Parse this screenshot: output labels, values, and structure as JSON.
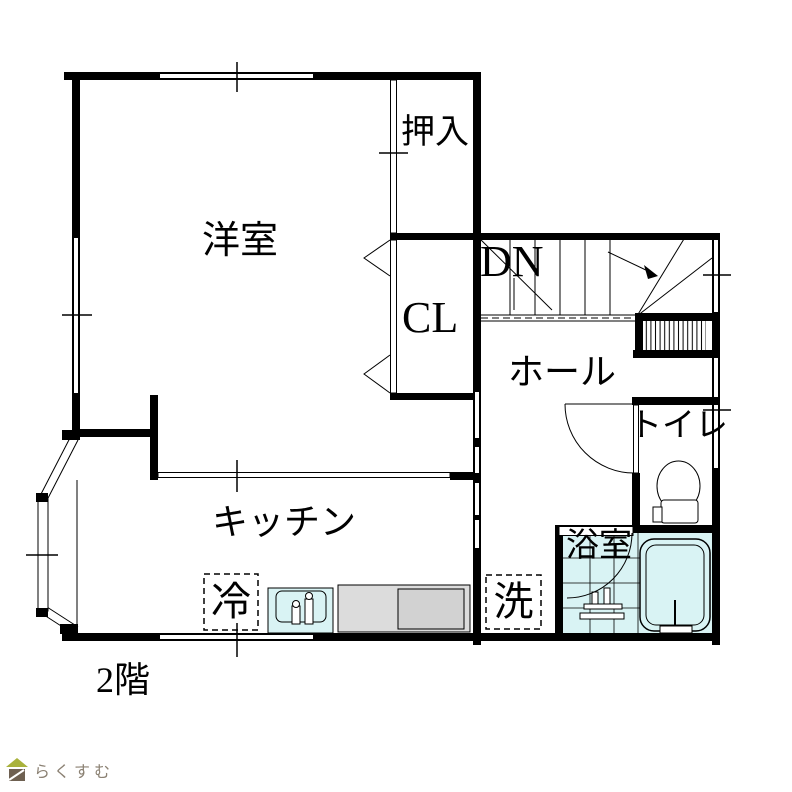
{
  "floor_plan": {
    "floor_label": "2階",
    "labels": {
      "western_room": "洋室",
      "oshiire_closet": "押入",
      "cl_closet": "CL",
      "stairs_down": "DN",
      "hall": "ホール",
      "toilet": "トイレ",
      "bathroom": "浴室",
      "kitchen": "キッチン",
      "refrigerator": "冷",
      "washer": "洗"
    },
    "colors": {
      "wall": "#000000",
      "water_fill": "#d9f3f4",
      "counter_fill": "#dcdcdc",
      "stove_fill": "#d2d2d2"
    },
    "branding": {
      "logo_text": "らくすむ",
      "roof_color": "#a9b23c",
      "body_color": "#6e6051",
      "text_color": "#8b8173"
    }
  }
}
